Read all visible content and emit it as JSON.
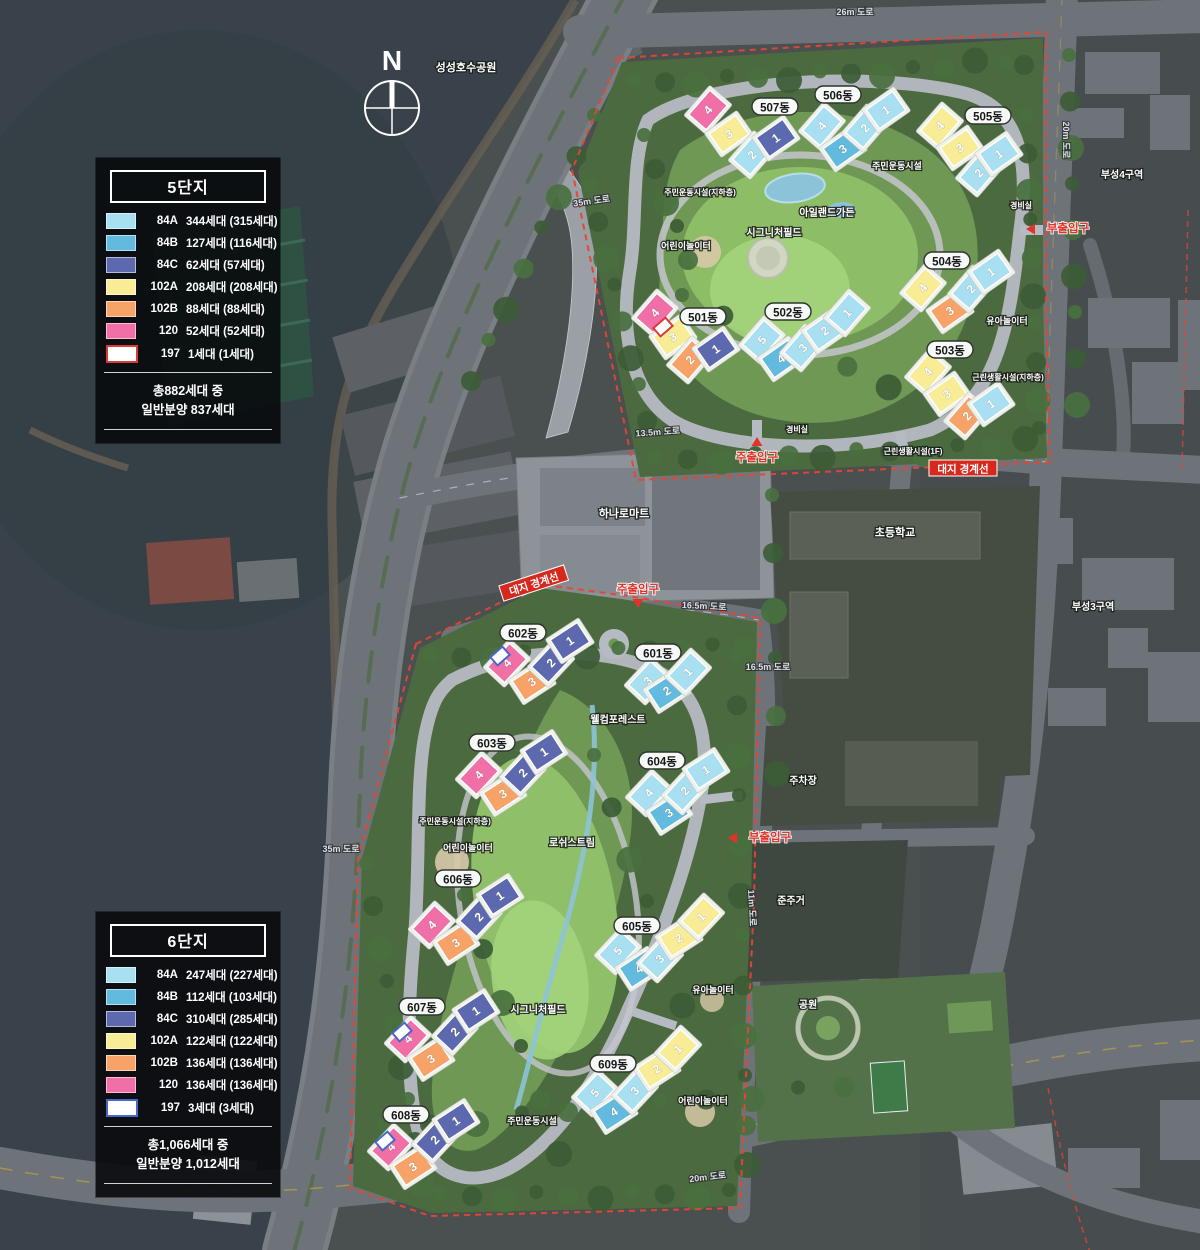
{
  "compass": {
    "label": "N"
  },
  "legends": [
    {
      "title": "5단지",
      "rows": [
        {
          "type": "84A",
          "count": "344세대 (315세대)",
          "color": "#a9e0f1"
        },
        {
          "type": "84B",
          "count": "127세대 (116세대)",
          "color": "#62bade"
        },
        {
          "type": "84C",
          "count": "62세대 (57세대)",
          "color": "#5d69af"
        },
        {
          "type": "102A",
          "count": "208세대 (208세대)",
          "color": "#f8ec97"
        },
        {
          "type": "102B",
          "count": "88세대 (88세대)",
          "color": "#f7a368"
        },
        {
          "type": "120",
          "count": "52세대 (52세대)",
          "color": "#ef6fa6"
        },
        {
          "type": "197",
          "count": "1세대 (1세대)",
          "color": "#ffffff",
          "border": "#d93a3a"
        }
      ],
      "total_line1": "총882세대 중",
      "total_line2": "일반분양 837세대"
    },
    {
      "title": "6단지",
      "rows": [
        {
          "type": "84A",
          "count": "247세대 (227세대)",
          "color": "#a9e0f1"
        },
        {
          "type": "84B",
          "count": "112세대 (103세대)",
          "color": "#62bade"
        },
        {
          "type": "84C",
          "count": "310세대 (285세대)",
          "color": "#5d69af"
        },
        {
          "type": "102A",
          "count": "122세대 (122세대)",
          "color": "#f8ec97"
        },
        {
          "type": "102B",
          "count": "136세대 (136세대)",
          "color": "#f7a368"
        },
        {
          "type": "120",
          "count": "136세대 (136세대)",
          "color": "#ef6fa6"
        },
        {
          "type": "197",
          "count": "3세대 (3세대)",
          "color": "#ffffff",
          "border": "#4a66c8"
        }
      ],
      "total_line1": "총1,066세대 중",
      "total_line2": "일반분양 1,012세대"
    }
  ],
  "unit_colors": {
    "84A": "#a9e0f1",
    "84B": "#62bade",
    "84C": "#5d69af",
    "102A": "#f8ec97",
    "102B": "#f7a368",
    "120": "#ef6fa6",
    "197": "#ffffff"
  },
  "map_colors": {
    "water": "#39424a",
    "land": "#49504f",
    "road": "#6e737a",
    "parcel_green": "#4c6a3f",
    "park_green": "#6f9855",
    "lawn": "#8fbf68",
    "boundary_red": "#e8452f",
    "entrance_red": "#e33327",
    "label_box_red": "#d6281d"
  },
  "buildings": [
    {
      "name": "501동",
      "rot": -42,
      "label": {
        "x": 703,
        "y": 319
      },
      "segments": [
        {
          "n": "4",
          "t": "120",
          "x": 655,
          "y": 313
        },
        {
          "n": "3",
          "t": "102A",
          "x": 673,
          "y": 337
        },
        {
          "n": "2",
          "t": "102B",
          "x": 690,
          "y": 360
        },
        {
          "n": "1",
          "t": "84C",
          "x": 716,
          "y": 349
        }
      ]
    },
    {
      "name": "502동",
      "rot": -42,
      "label": {
        "x": 788,
        "y": 314
      },
      "segments": [
        {
          "n": "5",
          "t": "84A",
          "x": 762,
          "y": 340
        },
        {
          "n": "4",
          "t": "84B",
          "x": 781,
          "y": 359
        },
        {
          "n": "3",
          "t": "84A",
          "x": 803,
          "y": 348
        },
        {
          "n": "2",
          "t": "84A",
          "x": 825,
          "y": 331
        },
        {
          "n": "1",
          "t": "84A",
          "x": 847,
          "y": 313
        }
      ]
    },
    {
      "name": "503동",
      "rot": -42,
      "label": {
        "x": 950,
        "y": 352
      },
      "segments": [
        {
          "n": "4",
          "t": "102A",
          "x": 928,
          "y": 372
        },
        {
          "n": "3",
          "t": "102A",
          "x": 947,
          "y": 394
        },
        {
          "n": "2",
          "t": "102B",
          "x": 967,
          "y": 416
        },
        {
          "n": "1",
          "t": "84A",
          "x": 991,
          "y": 404
        }
      ]
    },
    {
      "name": "504동",
      "rot": -42,
      "label": {
        "x": 947,
        "y": 263
      },
      "segments": [
        {
          "n": "4",
          "t": "102A",
          "x": 923,
          "y": 288
        },
        {
          "n": "3",
          "t": "102B",
          "x": 950,
          "y": 311
        },
        {
          "n": "2",
          "t": "84A",
          "x": 971,
          "y": 289
        },
        {
          "n": "1",
          "t": "84A",
          "x": 991,
          "y": 272
        }
      ]
    },
    {
      "name": "505동",
      "rot": -42,
      "label": {
        "x": 988,
        "y": 118
      },
      "segments": [
        {
          "n": "4",
          "t": "102A",
          "x": 940,
          "y": 126
        },
        {
          "n": "3",
          "t": "102A",
          "x": 960,
          "y": 148
        },
        {
          "n": "2",
          "t": "84A",
          "x": 979,
          "y": 173
        },
        {
          "n": "1",
          "t": "84A",
          "x": 999,
          "y": 154
        }
      ]
    },
    {
      "name": "506동",
      "rot": -42,
      "label": {
        "x": 838,
        "y": 97
      },
      "segments": [
        {
          "n": "4",
          "t": "84A",
          "x": 822,
          "y": 126
        },
        {
          "n": "3",
          "t": "84B",
          "x": 843,
          "y": 149
        },
        {
          "n": "2",
          "t": "84A",
          "x": 865,
          "y": 128
        },
        {
          "n": "1",
          "t": "84A",
          "x": 886,
          "y": 110
        }
      ]
    },
    {
      "name": "507동",
      "rot": -42,
      "label": {
        "x": 775,
        "y": 109
      },
      "segments": [
        {
          "n": "4",
          "t": "120",
          "x": 708,
          "y": 110
        },
        {
          "n": "3",
          "t": "102A",
          "x": 729,
          "y": 134
        },
        {
          "n": "2",
          "t": "84A",
          "x": 752,
          "y": 155
        },
        {
          "n": "1",
          "t": "84C",
          "x": 776,
          "y": 138
        }
      ]
    },
    {
      "name": "601동",
      "rot": -40,
      "label": {
        "x": 658,
        "y": 655
      },
      "segments": [
        {
          "n": "3",
          "t": "84A",
          "x": 648,
          "y": 681
        },
        {
          "n": "2",
          "t": "84B",
          "x": 667,
          "y": 691
        },
        {
          "n": "1",
          "t": "84A",
          "x": 688,
          "y": 672
        }
      ]
    },
    {
      "name": "602동",
      "rot": -40,
      "label": {
        "x": 523,
        "y": 635
      },
      "segments": [
        {
          "n": "4",
          "t": "120",
          "x": 507,
          "y": 663
        },
        {
          "n": "3",
          "t": "102B",
          "x": 532,
          "y": 682
        },
        {
          "n": "2",
          "t": "84C",
          "x": 551,
          "y": 663
        },
        {
          "n": "1",
          "t": "84C",
          "x": 570,
          "y": 641
        }
      ]
    },
    {
      "name": "603동",
      "rot": -40,
      "label": {
        "x": 492,
        "y": 745
      },
      "segments": [
        {
          "n": "4",
          "t": "120",
          "x": 479,
          "y": 775
        },
        {
          "n": "3",
          "t": "102B",
          "x": 503,
          "y": 794
        },
        {
          "n": "2",
          "t": "84C",
          "x": 523,
          "y": 773
        },
        {
          "n": "1",
          "t": "84C",
          "x": 544,
          "y": 752
        }
      ]
    },
    {
      "name": "604동",
      "rot": -40,
      "label": {
        "x": 662,
        "y": 763
      },
      "segments": [
        {
          "n": "4",
          "t": "84A",
          "x": 649,
          "y": 793
        },
        {
          "n": "3",
          "t": "84B",
          "x": 669,
          "y": 813
        },
        {
          "n": "2",
          "t": "84A",
          "x": 685,
          "y": 791
        },
        {
          "n": "1",
          "t": "84A",
          "x": 706,
          "y": 770
        }
      ]
    },
    {
      "name": "605동",
      "rot": -40,
      "label": {
        "x": 637,
        "y": 928
      },
      "segments": [
        {
          "n": "5",
          "t": "84A",
          "x": 618,
          "y": 951
        },
        {
          "n": "4",
          "t": "84B",
          "x": 639,
          "y": 969
        },
        {
          "n": "3",
          "t": "84A",
          "x": 660,
          "y": 959
        },
        {
          "n": "2",
          "t": "102A",
          "x": 679,
          "y": 938
        },
        {
          "n": "1",
          "t": "102A",
          "x": 701,
          "y": 917
        }
      ]
    },
    {
      "name": "606동",
      "rot": -40,
      "label": {
        "x": 458,
        "y": 881
      },
      "segments": [
        {
          "n": "4",
          "t": "120",
          "x": 432,
          "y": 925
        },
        {
          "n": "3",
          "t": "102B",
          "x": 456,
          "y": 943
        },
        {
          "n": "2",
          "t": "84C",
          "x": 479,
          "y": 917
        },
        {
          "n": "1",
          "t": "84C",
          "x": 500,
          "y": 896
        }
      ]
    },
    {
      "name": "607동",
      "rot": -40,
      "label": {
        "x": 422,
        "y": 1009
      },
      "segments": [
        {
          "n": "4",
          "t": "120",
          "x": 408,
          "y": 1039
        },
        {
          "n": "3",
          "t": "102B",
          "x": 431,
          "y": 1059
        },
        {
          "n": "2",
          "t": "84C",
          "x": 455,
          "y": 1032
        },
        {
          "n": "1",
          "t": "84C",
          "x": 476,
          "y": 1011
        }
      ]
    },
    {
      "name": "608동",
      "rot": -40,
      "label": {
        "x": 406,
        "y": 1117
      },
      "segments": [
        {
          "n": "4",
          "t": "120",
          "x": 391,
          "y": 1147
        },
        {
          "n": "3",
          "t": "102B",
          "x": 413,
          "y": 1167
        },
        {
          "n": "2",
          "t": "84C",
          "x": 435,
          "y": 1140
        },
        {
          "n": "1",
          "t": "84C",
          "x": 456,
          "y": 1121
        }
      ]
    },
    {
      "name": "609동",
      "rot": -40,
      "label": {
        "x": 613,
        "y": 1066
      },
      "segments": [
        {
          "n": "5",
          "t": "84A",
          "x": 595,
          "y": 1093
        },
        {
          "n": "4",
          "t": "84B",
          "x": 614,
          "y": 1112
        },
        {
          "n": "3",
          "t": "84A",
          "x": 635,
          "y": 1091
        },
        {
          "n": "2",
          "t": "102A",
          "x": 657,
          "y": 1069
        },
        {
          "n": "1",
          "t": "102A",
          "x": 678,
          "y": 1049
        }
      ]
    }
  ],
  "special_units": [
    {
      "x": 663,
      "y": 327,
      "border": "#d93a3a"
    },
    {
      "x": 500,
      "y": 656,
      "border": "#4a66c8"
    },
    {
      "x": 402,
      "y": 1032,
      "border": "#4a66c8"
    },
    {
      "x": 385,
      "y": 1141,
      "border": "#4a66c8"
    }
  ],
  "place_labels": [
    {
      "text": "성성호수공원",
      "x": 466,
      "y": 71,
      "size": 11
    },
    {
      "text": "하나로마트",
      "x": 624,
      "y": 517,
      "size": 11
    },
    {
      "text": "초등학교",
      "x": 895,
      "y": 536,
      "size": 11
    },
    {
      "text": "부성4구역",
      "x": 1122,
      "y": 178,
      "size": 10
    },
    {
      "text": "부성3구역",
      "x": 1093,
      "y": 610,
      "size": 10
    },
    {
      "text": "주차장",
      "x": 803,
      "y": 784,
      "size": 10
    },
    {
      "text": "준주거",
      "x": 791,
      "y": 904,
      "size": 10
    },
    {
      "text": "공원",
      "x": 808,
      "y": 1008,
      "size": 10
    },
    {
      "text": "어린이놀이터",
      "x": 686,
      "y": 249,
      "size": 9
    },
    {
      "text": "어린이놀이터",
      "x": 468,
      "y": 851,
      "size": 9
    },
    {
      "text": "어린이놀이터",
      "x": 703,
      "y": 1104,
      "size": 9
    },
    {
      "text": "유아놀이터",
      "x": 1007,
      "y": 324,
      "size": 9
    },
    {
      "text": "유아놀이터",
      "x": 713,
      "y": 993,
      "size": 9
    },
    {
      "text": "주민운동시설",
      "x": 897,
      "y": 169,
      "size": 9
    },
    {
      "text": "주민운동시설",
      "x": 532,
      "y": 1124,
      "size": 9
    },
    {
      "text": "아일랜드가든",
      "x": 827,
      "y": 216,
      "size": 10
    },
    {
      "text": "시그니처필드",
      "x": 774,
      "y": 236,
      "size": 10
    },
    {
      "text": "시그니처필드",
      "x": 538,
      "y": 1013,
      "size": 10
    },
    {
      "text": "웰컴포레스트",
      "x": 618,
      "y": 723,
      "size": 10
    },
    {
      "text": "로쉬스트림",
      "x": 572,
      "y": 846,
      "size": 10
    },
    {
      "text": "근린생활시설(1F)",
      "x": 913,
      "y": 454,
      "size": 8
    },
    {
      "text": "근린생활시설(지하층)",
      "x": 1008,
      "y": 380,
      "size": 8
    },
    {
      "text": "주민운동시설(지하층)",
      "x": 700,
      "y": 195,
      "size": 8
    },
    {
      "text": "주민운동시설(지하층)",
      "x": 455,
      "y": 824,
      "size": 8
    },
    {
      "text": "경비실",
      "x": 797,
      "y": 432,
      "size": 8
    },
    {
      "text": "경비실",
      "x": 1021,
      "y": 208,
      "size": 8
    }
  ],
  "road_labels": [
    {
      "text": "26m 도로",
      "x": 855,
      "y": 15,
      "rot": 0
    },
    {
      "text": "20m 도로",
      "x": 1063,
      "y": 140,
      "rot": 90
    },
    {
      "text": "35m 도로",
      "x": 592,
      "y": 204,
      "rot": -8
    },
    {
      "text": "35m 도로",
      "x": 341,
      "y": 852,
      "rot": 0
    },
    {
      "text": "13.5m 도로",
      "x": 658,
      "y": 435,
      "rot": -4
    },
    {
      "text": "16.5m 도로",
      "x": 704,
      "y": 609,
      "rot": 3
    },
    {
      "text": "16.5m 도로",
      "x": 768,
      "y": 670,
      "rot": 0
    },
    {
      "text": "11m 도로",
      "x": 749,
      "y": 908,
      "rot": 87
    },
    {
      "text": "20m 도로",
      "x": 708,
      "y": 1180,
      "rot": -7
    }
  ],
  "boundary_labels": [
    {
      "text": "대지 경계선",
      "x": 963,
      "y": 469,
      "rot": 0
    },
    {
      "text": "대지 경계선",
      "x": 534,
      "y": 584,
      "rot": -18
    }
  ],
  "entrances": [
    {
      "text": "주출입구",
      "x": 757,
      "y": 458,
      "dir": "up"
    },
    {
      "text": "주출입구",
      "x": 638,
      "y": 590,
      "dir": "down"
    },
    {
      "text": "부출입구",
      "x": 1068,
      "y": 229,
      "dir": "left"
    },
    {
      "text": "부출입구",
      "x": 770,
      "y": 838,
      "dir": "left"
    }
  ]
}
